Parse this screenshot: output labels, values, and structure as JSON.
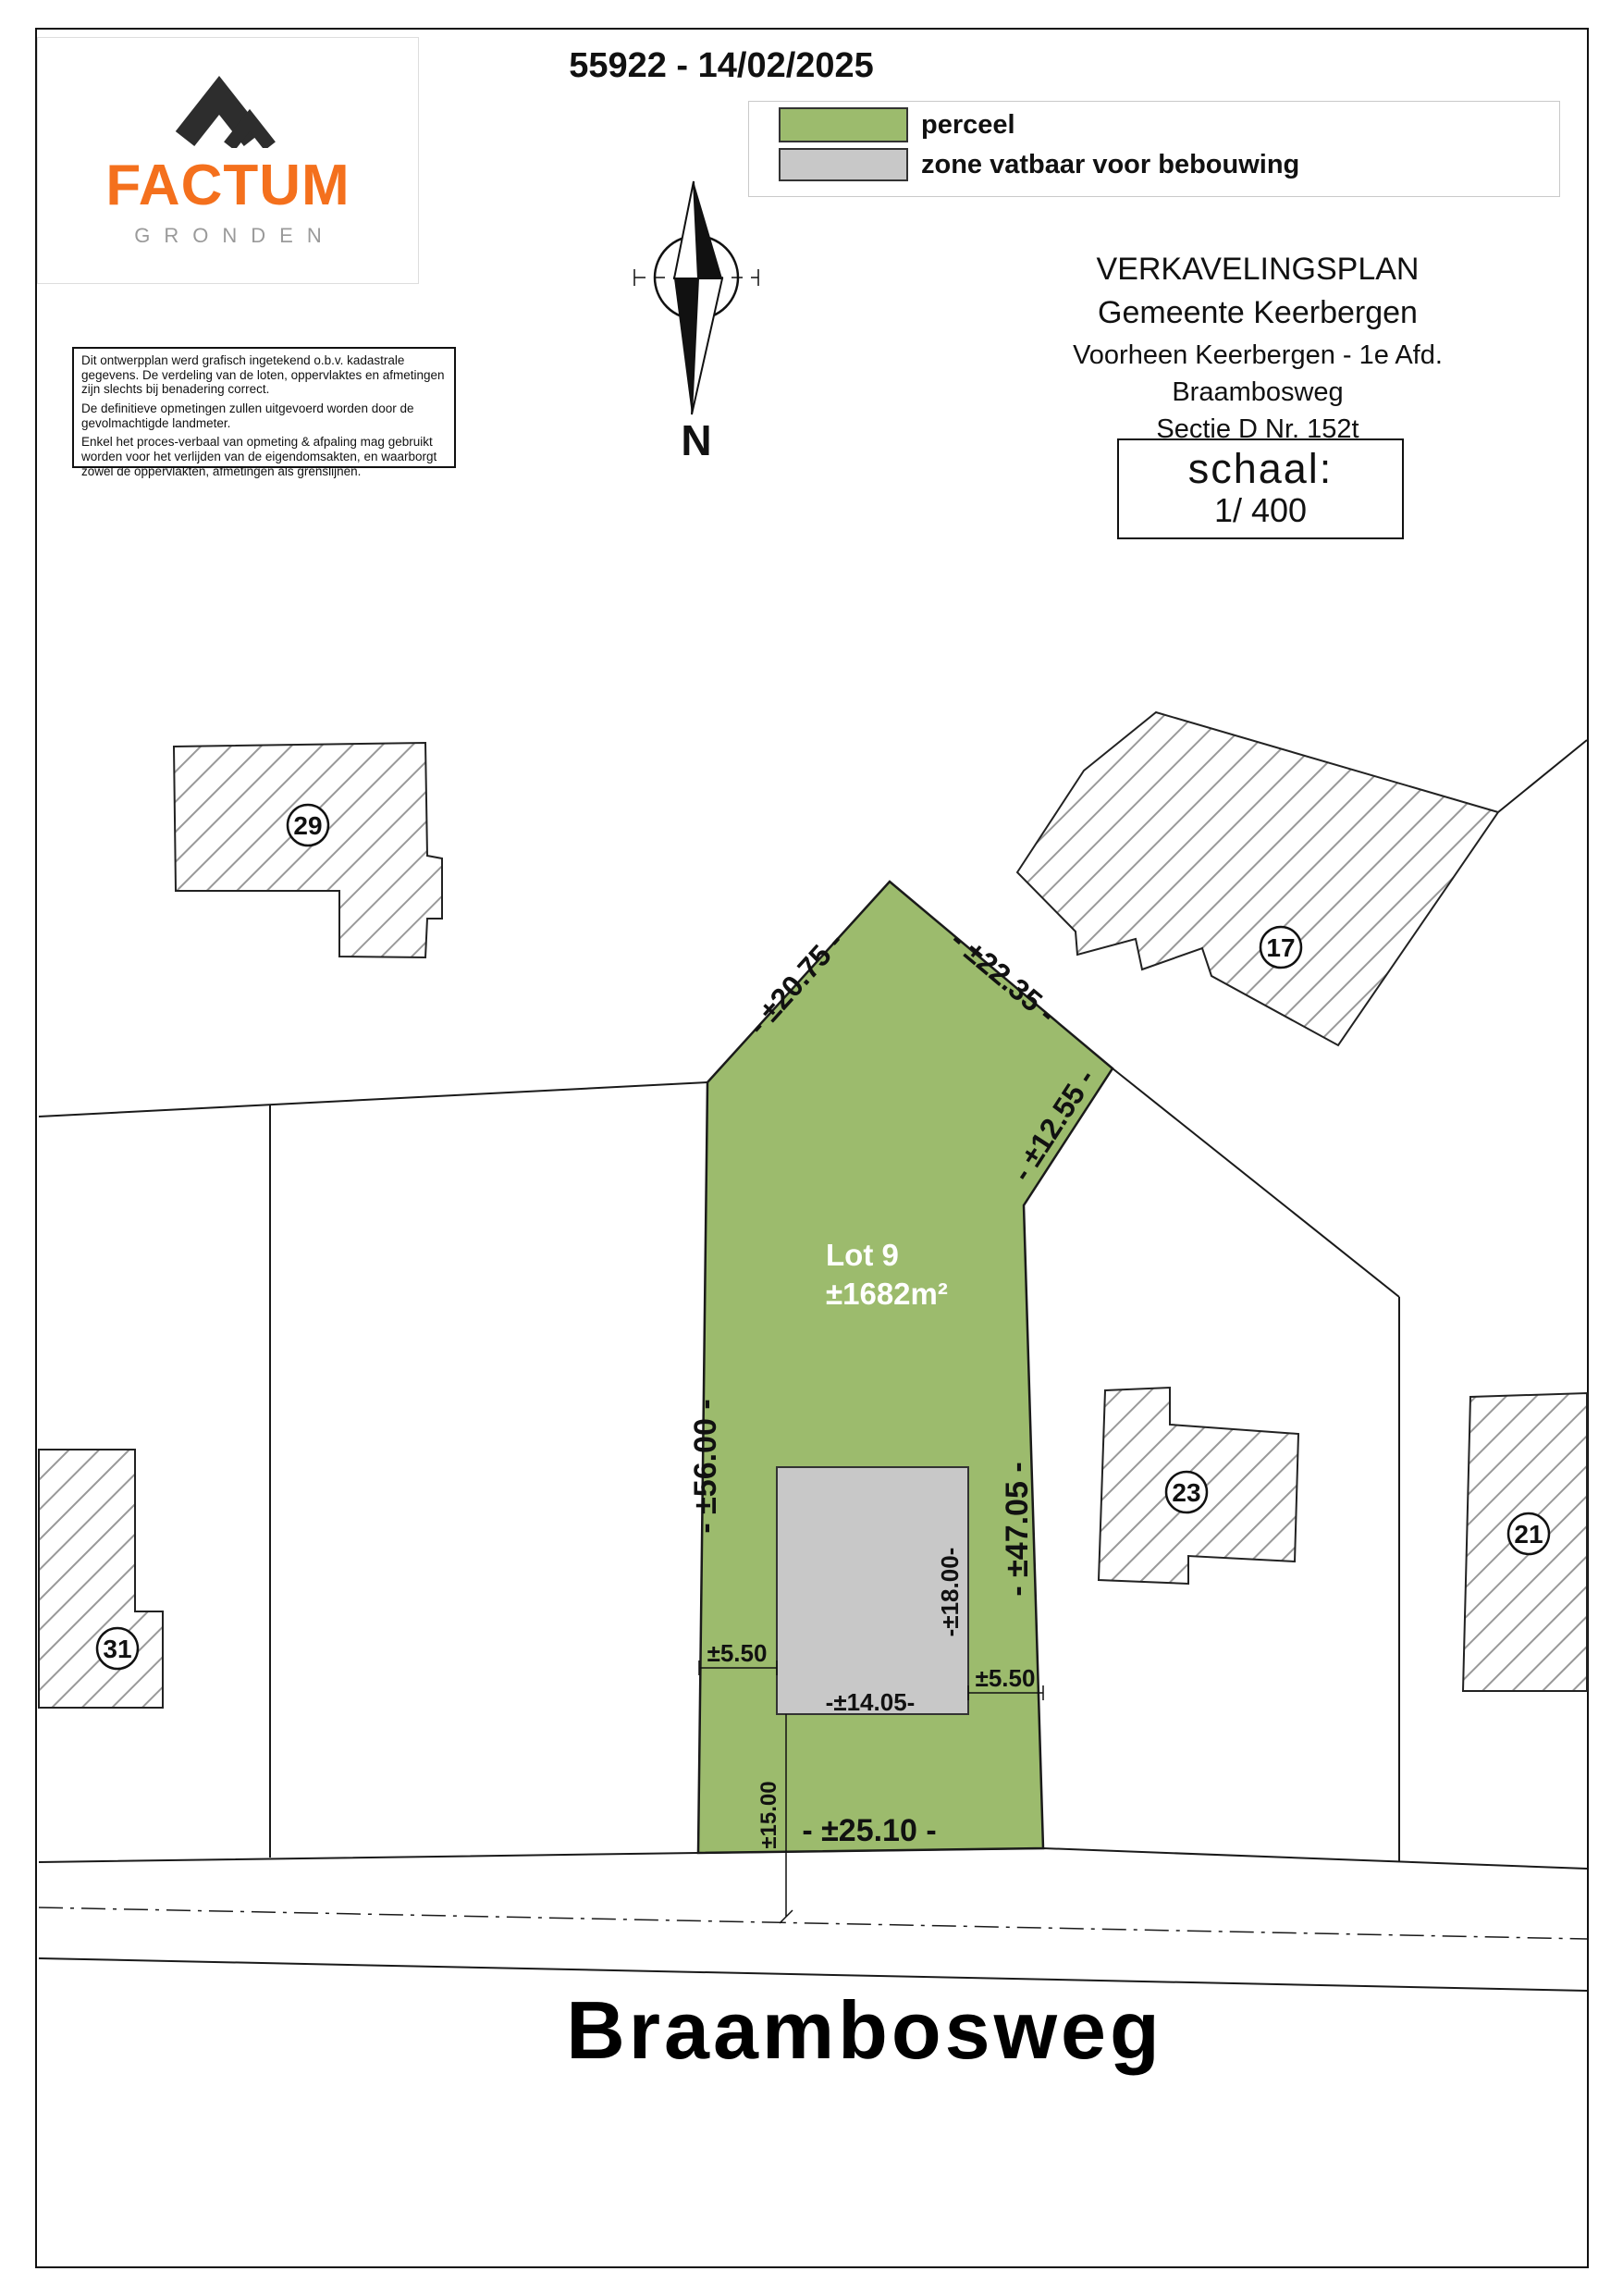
{
  "page": {
    "doc_ref": "55922 - 14/02/2025"
  },
  "logo": {
    "brand": "FACTUM",
    "subtitle": "GRONDEN"
  },
  "legend": {
    "perceel_label": "perceel",
    "zone_label": "zone vatbaar voor bebouwing"
  },
  "disclaimer": {
    "p1": "Dit ontwerpplan werd grafisch ingetekend o.b.v. kadastrale gegevens. De verdeling van de loten, oppervlaktes en afmetingen zijn slechts bij benadering correct.",
    "p2": "De definitieve opmetingen zullen uitgevoerd worden door de gevolmachtigde landmeter.",
    "p3": "Enkel het proces-verbaal van opmeting & afpaling mag gebruikt worden voor het verlijden van de eigendomsakten, en waarborgt zowel de oppervlakten, afmetingen als grenslijnen."
  },
  "titleblock": {
    "title": "VERKAVELINGSPLAN",
    "municipality": "Gemeente Keerbergen",
    "formerly": "Voorheen Keerbergen - 1e Afd.",
    "street": "Braambosweg",
    "section": "Sectie D Nr. 152t",
    "scale_label": "schaal:",
    "scale_value": "1/ 400"
  },
  "compass": {
    "north": "N"
  },
  "plan": {
    "lot_name": "Lot 9",
    "lot_area": "±1682m²",
    "street_name": "Braambosweg",
    "dimensions": {
      "top_left_edge": "- ±20.75 -",
      "top_right_edge": "- ±22.35 -",
      "right_diagonal_edge": "- ±12.55 -",
      "left_edge": "- ±56.00 -",
      "right_edge": "- ±47.05 -",
      "zone_depth": "-±18.00-",
      "side_setback_left": "±5.50",
      "side_setback_right": "±5.50",
      "zone_width": "-±14.05-",
      "front_setback": "±15.00",
      "street_frontage": "- ±25.10 -"
    },
    "neighbors": [
      {
        "id": "29"
      },
      {
        "id": "17"
      },
      {
        "id": "23"
      },
      {
        "id": "21"
      },
      {
        "id": "31"
      }
    ]
  },
  "colors": {
    "parcel_green": "#9cbb6d",
    "zone_gray": "#c8c8c8",
    "brand_orange": "#f4701d",
    "hatch_gray": "#999999"
  }
}
